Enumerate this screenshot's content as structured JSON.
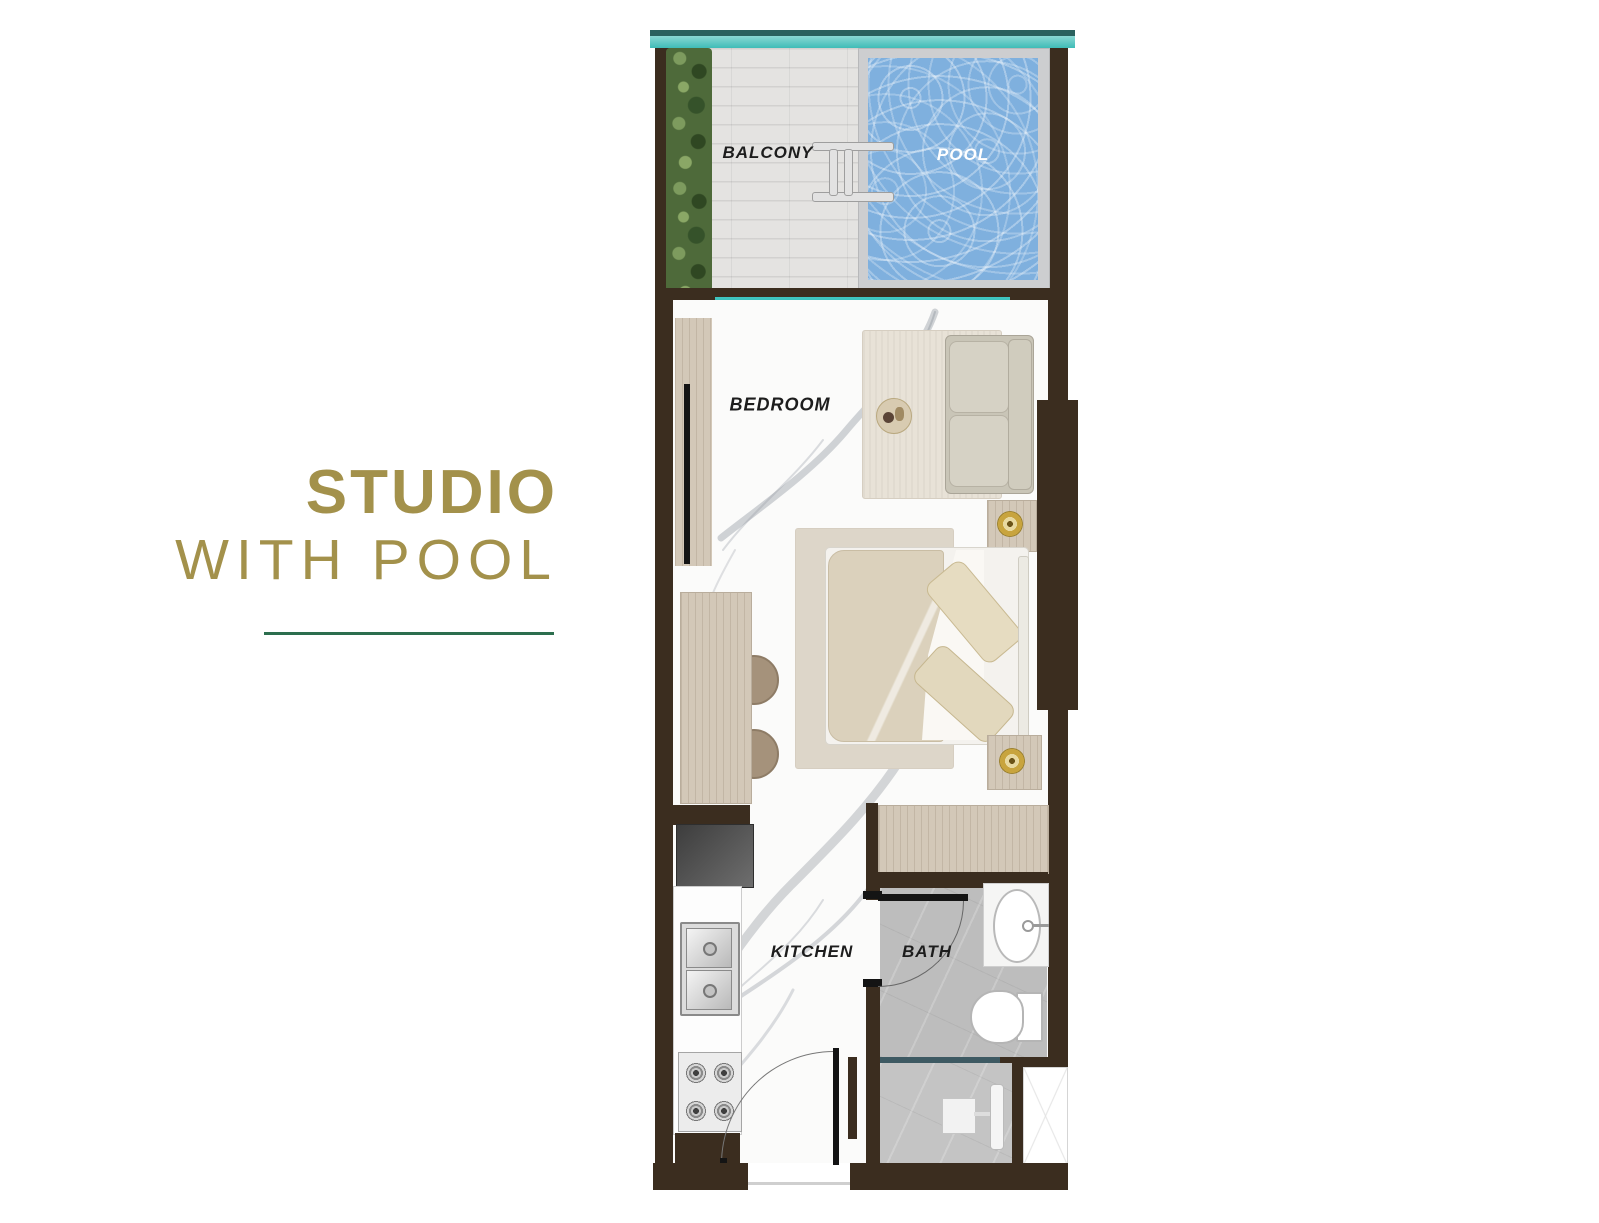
{
  "title": {
    "heading": "STUDIO",
    "subheading": "WITH POOL"
  },
  "floorplan": {
    "labels": {
      "balcony": "BALCONY",
      "pool": "POOL",
      "bedroom": "BEDROOM",
      "kitchen": "KITCHEN",
      "bath": "BATH"
    }
  },
  "colors": {
    "accent-gold": "#a3914b",
    "divider-green": "#2c6e4e",
    "wall-brown": "#3b2d1f",
    "glass-teal": "#2ab9b4",
    "pool-blue": "#7fb0de",
    "bath-gray": "#bdbdbd",
    "wood-beige": "#d3c8b8"
  }
}
